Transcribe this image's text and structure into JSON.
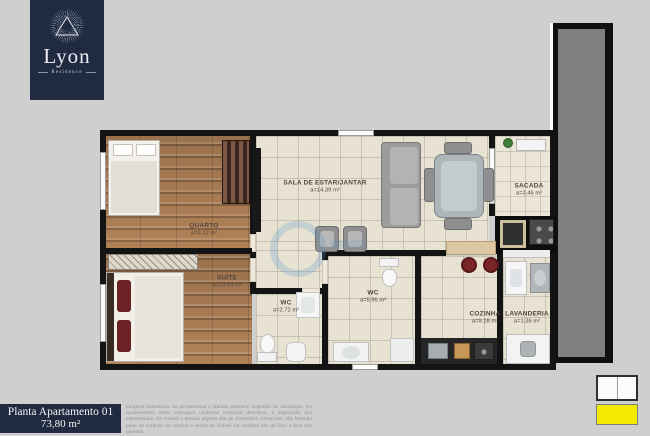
{
  "logo": {
    "title": "Lyon",
    "subtitle": "Residence"
  },
  "rooms": {
    "quarto": {
      "name": "QUARTO",
      "area": "a=8.32 m²"
    },
    "suite": {
      "name": "SUÍTE",
      "area": "a=10.54 m²"
    },
    "sala": {
      "name": "SALA DE ESTAR/JANTAR",
      "area": "a=14.39 m²"
    },
    "sacada": {
      "name": "SACADA",
      "area": "a=3.46 m²"
    },
    "wc_suite": {
      "name": "WC",
      "area": "a=2.72 m²"
    },
    "wc_social": {
      "name": "WC",
      "area": "a=5.96 m²"
    },
    "cozinha": {
      "name": "COZINHA",
      "area": "a=9.18 m²"
    },
    "lavanderia": {
      "name": "LAVANDERIA",
      "area": "a=1.36 m²"
    }
  },
  "footer": {
    "plan_title": "Planta Apartamento 01",
    "total_area": "73,80 m²",
    "disclaimer": "Imagens ilustrativas, as perspectivas e plantas possuem sugestão de decoração. Os acabamentos serão entregues conforme memorial descritivo, à disposição dos interessados. Os móveis e demais objetos são de dimensões comerciais, não fazendo parte do contrato de compra e venda do imóvel. As medidas são de face a face das paredes."
  },
  "colors": {
    "brand_navy": "#202a40",
    "wall_black": "#141414",
    "keyplan_highlight": "#f2ea00",
    "wood_floor": "#a97f58",
    "tile_floor": "#e8e2d3"
  }
}
